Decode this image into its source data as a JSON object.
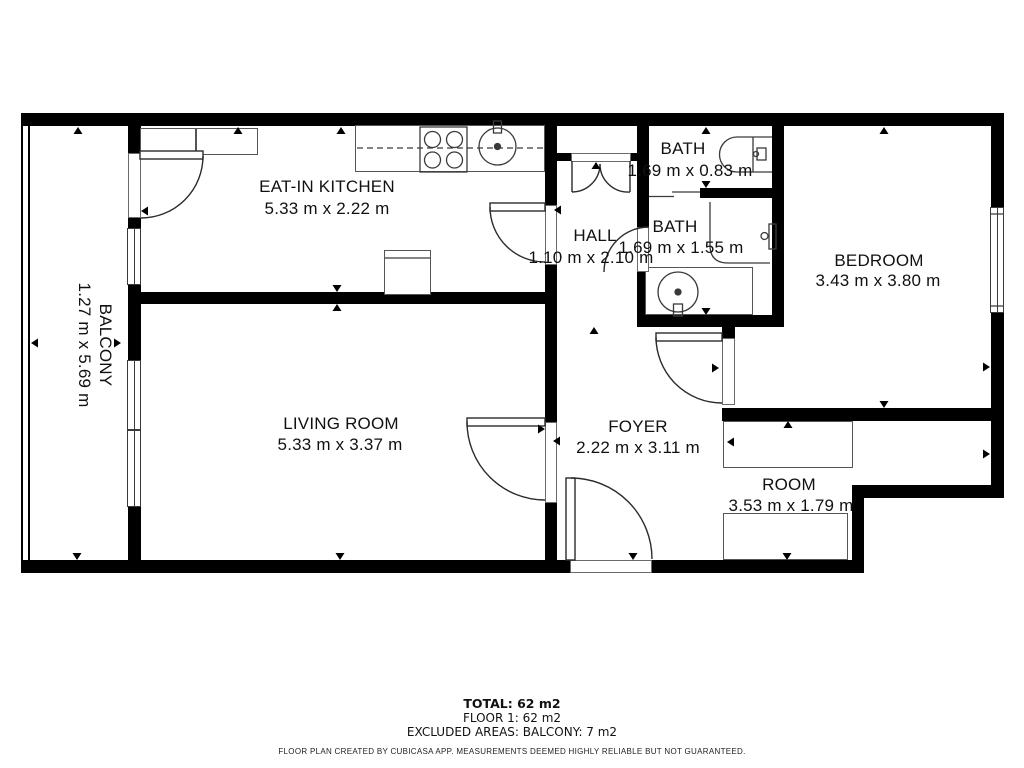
{
  "floorplan": {
    "rooms": [
      {
        "id": "kitchen",
        "name": "EAT-IN KITCHEN",
        "dims": "5.33 m x 2.22 m"
      },
      {
        "id": "hall",
        "name": "HALL",
        "dims": "1.10 m x 2.10 m"
      },
      {
        "id": "bath_top",
        "name": "BATH",
        "dims": "1.69 m x 0.83 m"
      },
      {
        "id": "bath",
        "name": "BATH",
        "dims": "1.69 m x 1.55 m"
      },
      {
        "id": "bedroom",
        "name": "BEDROOM",
        "dims": "3.43 m x 3.80 m"
      },
      {
        "id": "balcony",
        "name": "BALCONY",
        "dims": "1.27 m x 5.69 m"
      },
      {
        "id": "living",
        "name": "LIVING ROOM",
        "dims": "5.33 m x 3.37 m"
      },
      {
        "id": "foyer",
        "name": "FOYER",
        "dims": "2.22 m x 3.11 m"
      },
      {
        "id": "room",
        "name": "ROOM",
        "dims": "3.53 m x 1.79 m"
      }
    ],
    "summary": {
      "total": "TOTAL: 62 m2",
      "floor": "FLOOR 1: 62 m2",
      "excluded": "EXCLUDED AREAS: BALCONY: 7 m2"
    },
    "disclaimer": "FLOOR PLAN CREATED BY CUBICASA APP. MEASUREMENTS DEEMED HIGHLY RELIABLE BUT NOT GUARANTEED.",
    "colors": {
      "wall": "#000000",
      "background": "#ffffff",
      "fixture_line": "#3a3a3a"
    }
  }
}
